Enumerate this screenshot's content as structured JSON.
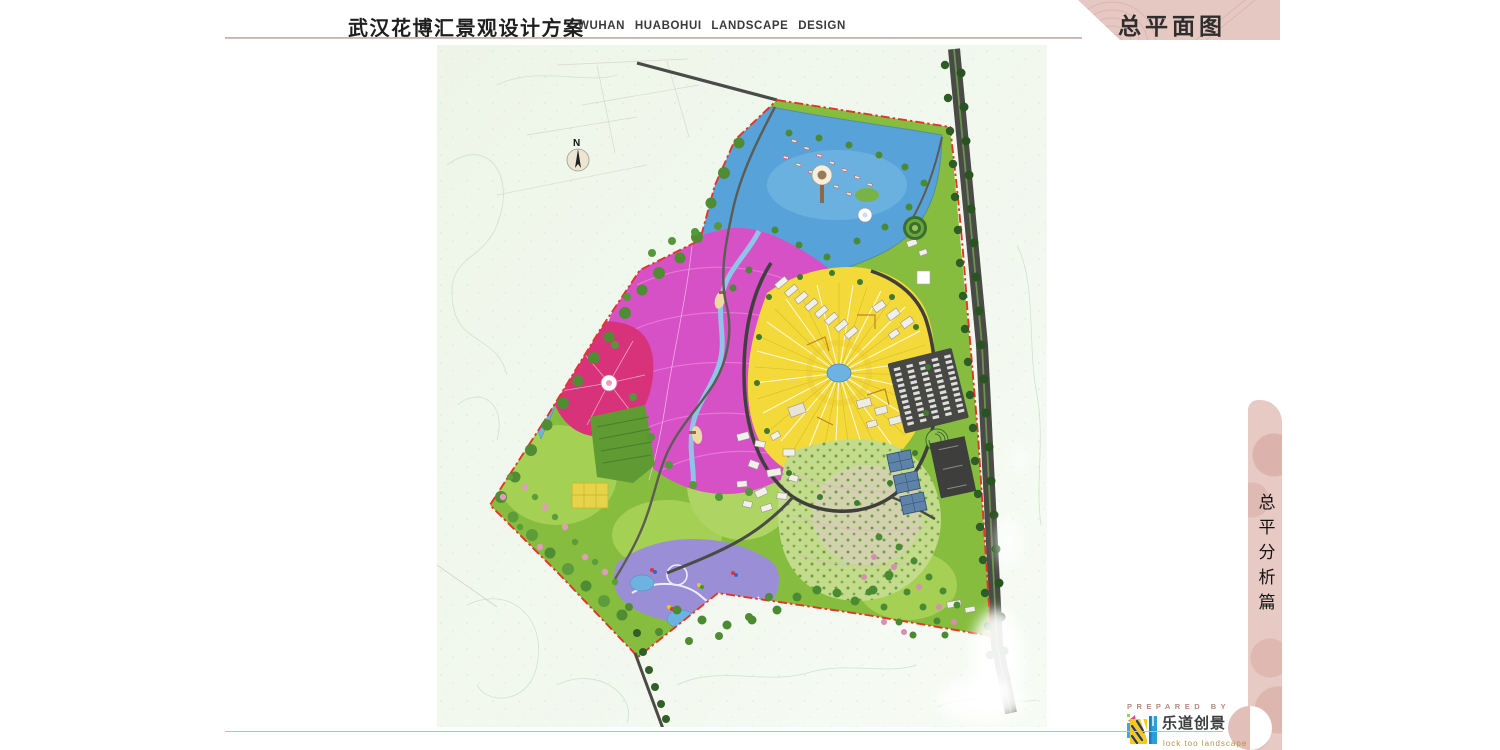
{
  "header": {
    "title_cn": "武汉花博汇景观设计方案",
    "title_en": "WUHAN  HUABOHUI  LANDSCAPE  DESIGN"
  },
  "banner": {
    "label": "总平面图"
  },
  "side_tab": {
    "label": "总平分析篇"
  },
  "map": {
    "compass_label": "N"
  },
  "footer": {
    "prepared_by_label": "PREPARED BY",
    "brand_cn": "乐道创景",
    "brand_en": "lock too landscape"
  },
  "colors": {
    "banner_pink": "#e6c8c2",
    "boundary_red": "#e33424",
    "site_green": "#86bd3e",
    "lake_blue": "#57a3d9",
    "flower_field_magenta": "#d551c5",
    "rose_garden_crimson": "#d8337a",
    "radial_field_yellow": "#f4d93b",
    "play_zone_purple": "#9a8fd6",
    "road_dark": "#4a4a47"
  }
}
